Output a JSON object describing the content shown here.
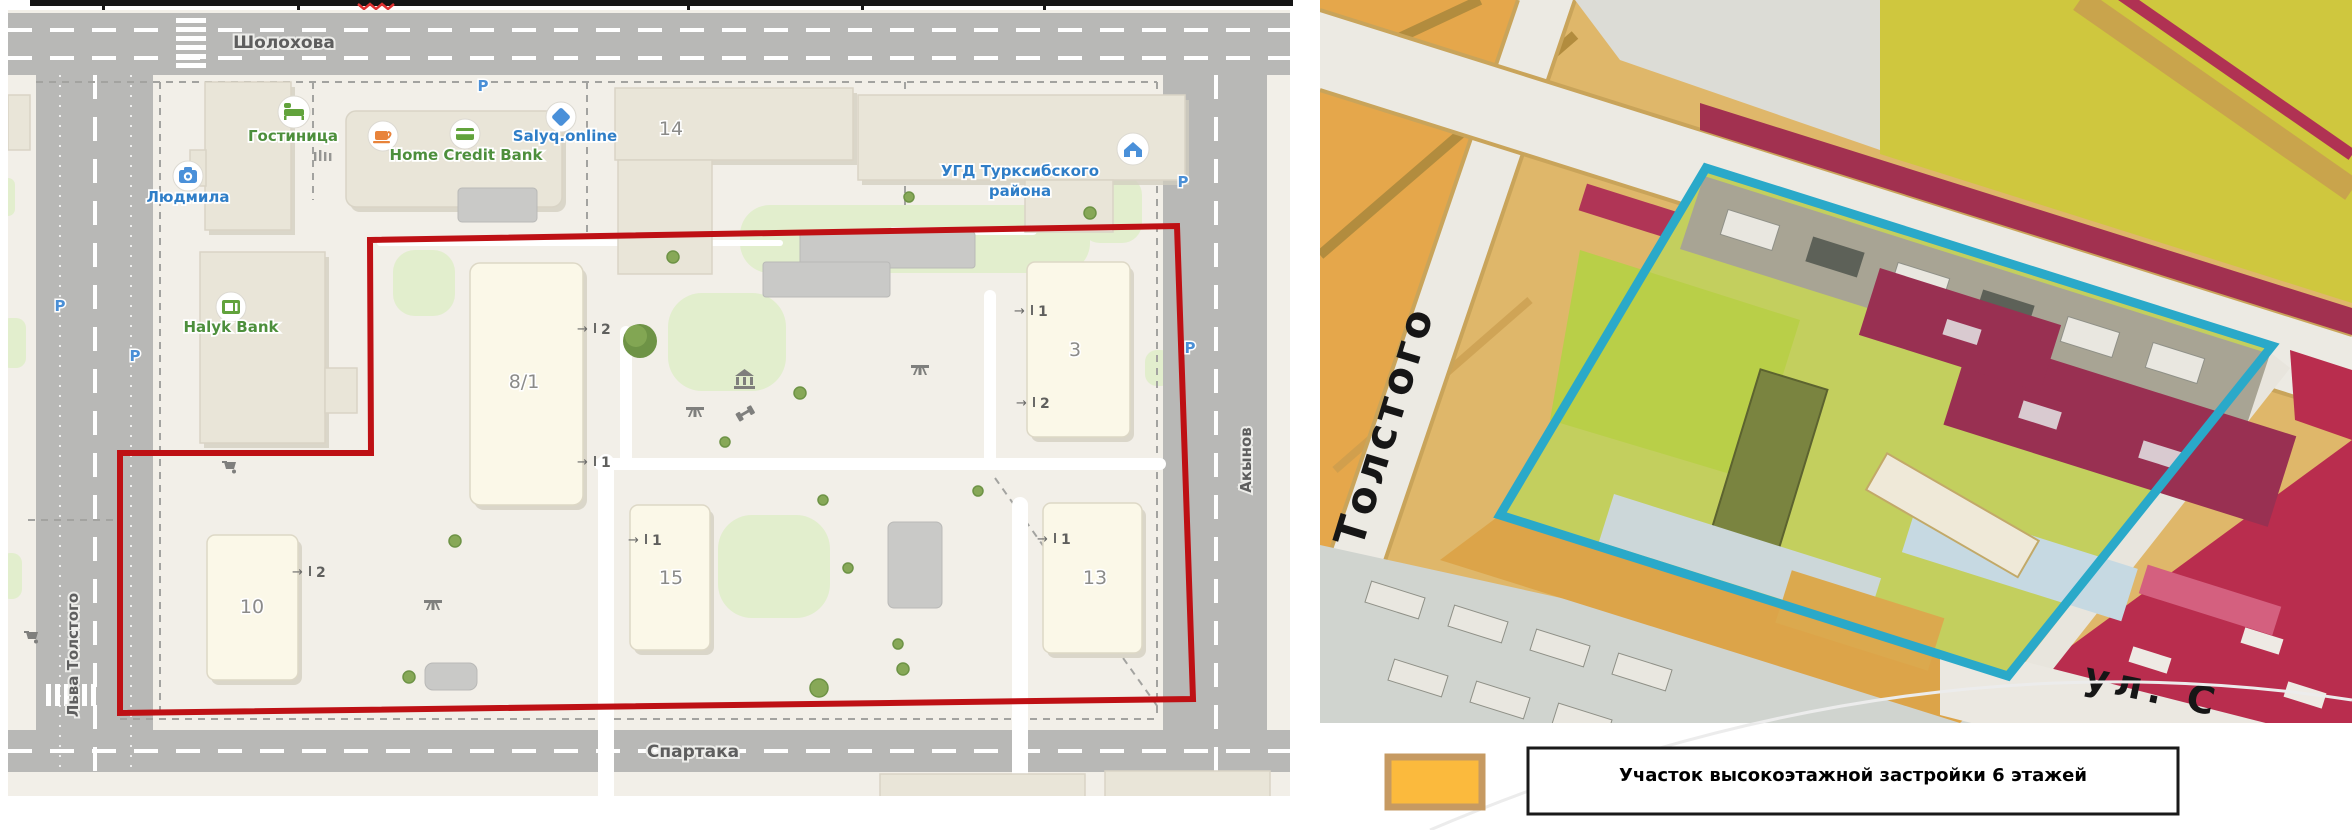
{
  "left_map": {
    "streets": {
      "top": "Шолохова",
      "bottom": "Спартака",
      "left": "Льва Толстого",
      "right": "Акынов"
    },
    "parking_label": "P",
    "boundary_color": "#be1014",
    "pois": [
      {
        "name": "Гостиница",
        "icon": "bed-icon",
        "color": "#4d8f3c"
      },
      {
        "name": "Людмила",
        "icon": "camera-icon",
        "color": "#2f7ec7"
      },
      {
        "name": "Home Credit Bank",
        "icon": "bank-card-icon",
        "color": "#4d8f3c"
      },
      {
        "name": "Salyq.online",
        "icon": "diamond-icon",
        "color": "#2f7ec7"
      },
      {
        "name": "УГД Турксибского",
        "name_line2": "района",
        "icon": "house-icon",
        "color": "#2f7ec7"
      },
      {
        "name": "Halyk Bank",
        "icon": "atm-icon",
        "color": "#4d8f3c"
      }
    ],
    "buildings": {
      "b14": "14",
      "b8_1": "8/1",
      "b3": "3",
      "b15": "15",
      "b13": "13",
      "b10": "10"
    },
    "entrances": {
      "b8_1_top": "2",
      "b8_1_bottom": "1",
      "b15": "1",
      "b3_top": "1",
      "b3_bottom": "2",
      "b13": "1",
      "b10": "2"
    }
  },
  "right_map": {
    "street_main": "Толстого",
    "street_bottom": "ул. С",
    "outline_color": "#2aa9c9"
  },
  "legend": {
    "swatch_color": "#fbba3d",
    "swatch_border": "#c69a62",
    "label": "Участок высокоэтажной застройки 6 этажей"
  }
}
